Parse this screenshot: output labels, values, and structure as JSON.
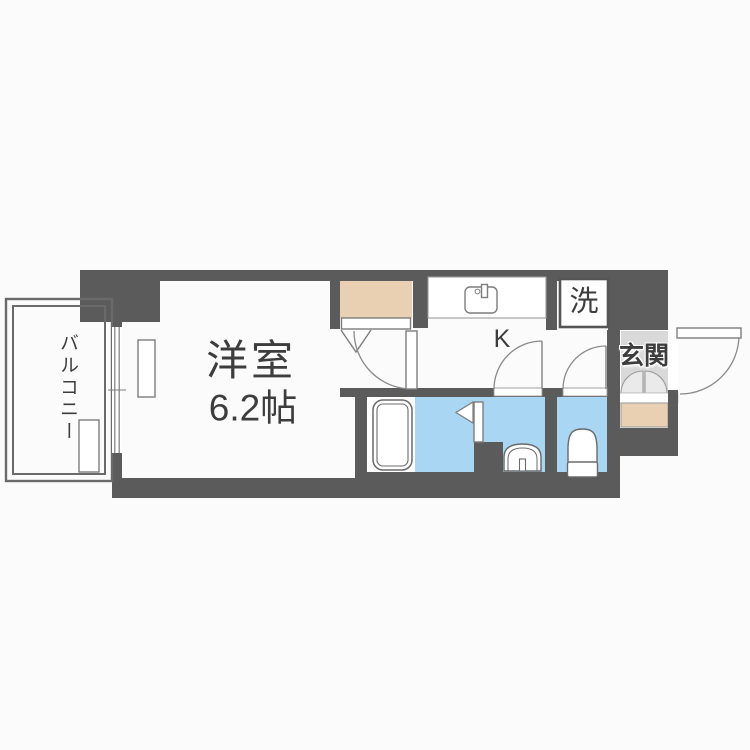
{
  "floorplan": {
    "type": "apartment-1K",
    "rooms": {
      "balcony": {
        "label": "バルコニー"
      },
      "main_room": {
        "label": "洋室",
        "size": "6.2帖"
      },
      "kitchen": {
        "label": "K"
      },
      "laundry": {
        "label": "洗"
      },
      "entrance": {
        "label": "玄関"
      }
    },
    "fixtures": [
      "kitchen-sink",
      "bathtub",
      "washbasin",
      "toilet",
      "closet",
      "entrance-step",
      "washing-machine-pan",
      "window",
      "doors"
    ],
    "colors": {
      "wall": "#5b5b5b",
      "wet_area": "#a9d6f2",
      "closet_and_step": "#e9d0b3",
      "entrance_tile": "#d9d9d9",
      "background": "#fbfbfb",
      "text": "#3d3d3d"
    }
  }
}
